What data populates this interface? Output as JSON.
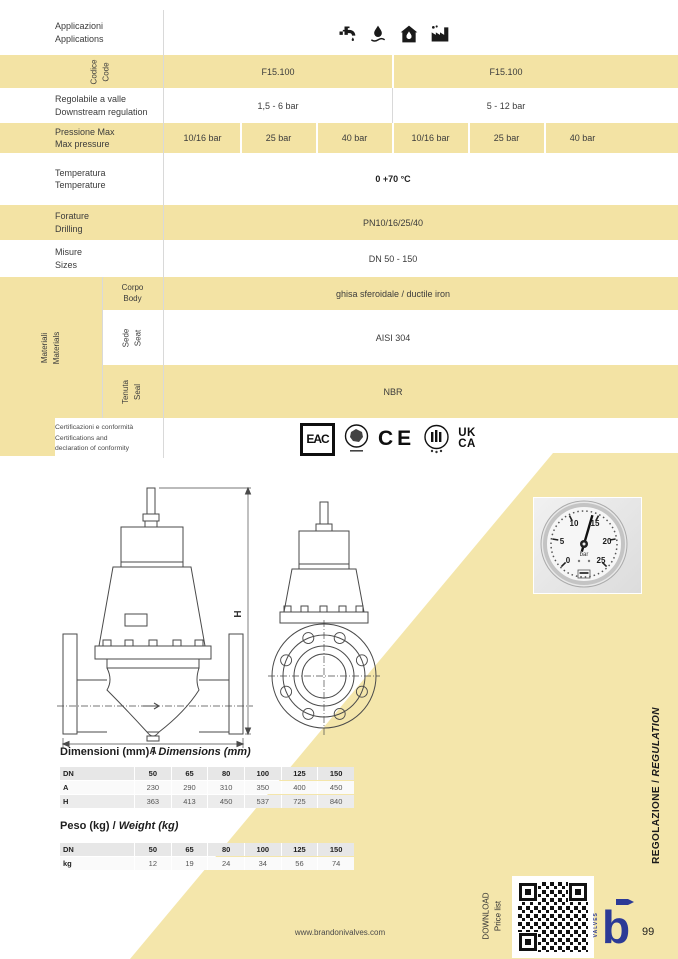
{
  "page": {
    "website": "www.brandonivalves.com",
    "number": "99",
    "sidebar": {
      "it": "REGOLAZIONE /",
      "en": "REGULATION"
    },
    "download": {
      "line1": "DOWNLOAD",
      "line2": "Price list"
    },
    "brand": {
      "letter": "b",
      "valves": "VALVES"
    }
  },
  "colors": {
    "row_yellow": "#f3e3a4",
    "diagonal_yellow": "#f4e6ab",
    "brand_blue": "#2c3a96"
  },
  "icons": [
    "faucet-icon",
    "water-drop-icon",
    "house-water-icon",
    "factory-icon"
  ],
  "spec": {
    "applications": {
      "it": "Applicazioni",
      "en": "Applications"
    },
    "code": {
      "it": "Codice",
      "en": "Code",
      "v1": "F15.100",
      "v2": "F15.100"
    },
    "regulation": {
      "it": "Regolabile a valle",
      "en": "Downstream regulation",
      "v1": "1,5 - 6 bar",
      "v2": "5 - 12 bar"
    },
    "pressure": {
      "it": "Pressione Max",
      "en": "Max pressure",
      "v": [
        "10/16 bar",
        "25 bar",
        "40 bar",
        "10/16 bar",
        "25 bar",
        "40 bar"
      ]
    },
    "temperature": {
      "it": "Temperatura",
      "en": "Temperature",
      "v": "0 +70 °C"
    },
    "drilling": {
      "it": "Forature",
      "en": "Drilling",
      "v": "PN10/16/25/40"
    },
    "sizes": {
      "it": "Misure",
      "en": "Sizes",
      "v": "DN 50 - 150"
    },
    "materials": {
      "it": "Materiali",
      "en": "Materials",
      "body": {
        "it": "Corpo",
        "en": "Body",
        "v": "ghisa sferoidale / ductile iron"
      },
      "seat": {
        "it": "Sede",
        "en": "Seat",
        "v": "AISI 304"
      },
      "seal": {
        "it": "Tenuta",
        "en": "Seal",
        "v": "NBR"
      }
    },
    "certifications": {
      "l1": "Certificazioni e conformità",
      "l2": "Certifications and",
      "l3": "declaration of conformity",
      "eac": "EAC",
      "ce": "CE",
      "uk": "UK",
      "ca": "CA"
    }
  },
  "drawing": {
    "width_label": "A",
    "height_label": "H"
  },
  "gauge": {
    "unit": "bar",
    "ticks": [
      "0",
      "5",
      "10",
      "15",
      "20",
      "25"
    ]
  },
  "dim_table": {
    "title_it": "Dimensioni (mm)",
    "sep": " / ",
    "title_en": "Dimensions (mm)",
    "header": [
      "DN",
      "50",
      "65",
      "80",
      "100",
      "125",
      "150"
    ],
    "rows": [
      {
        "label": "A",
        "v": [
          "230",
          "290",
          "310",
          "350",
          "400",
          "450"
        ]
      },
      {
        "label": "H",
        "v": [
          "363",
          "413",
          "450",
          "537",
          "725",
          "840"
        ]
      }
    ]
  },
  "weight_table": {
    "title_it": "Peso (kg)",
    "sep": " / ",
    "title_en": "Weight (kg)",
    "header": [
      "DN",
      "50",
      "65",
      "80",
      "100",
      "125",
      "150"
    ],
    "rows": [
      {
        "label": "kg",
        "v": [
          "12",
          "19",
          "24",
          "34",
          "56",
          "74"
        ]
      }
    ]
  }
}
